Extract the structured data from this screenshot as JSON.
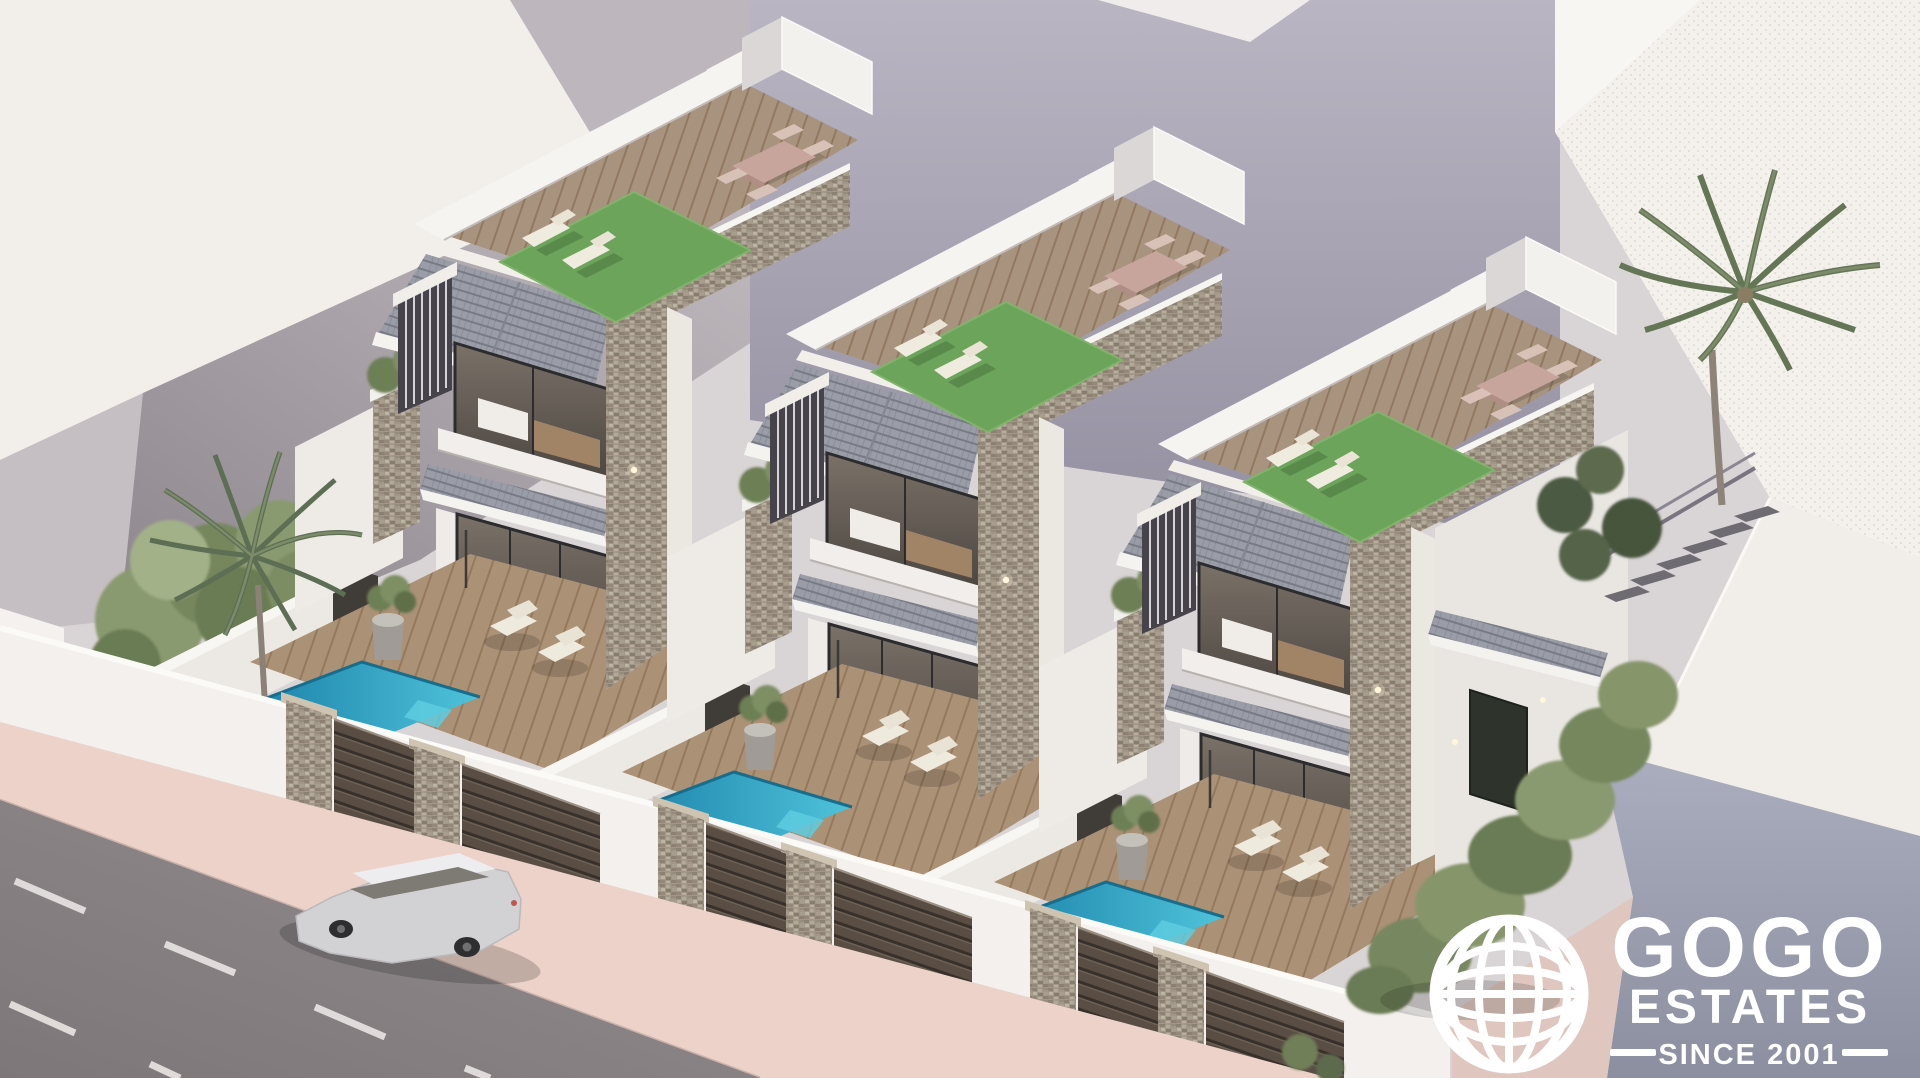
{
  "watermark": {
    "icon": "globe-icon",
    "brand_top": "GOGO",
    "brand_bottom": "ESTATES",
    "tagline": "SINCE 2001",
    "color": "#ffffff"
  },
  "scene": {
    "type": "architectural-exterior-render",
    "description": "Aerial 3D rendering of a row of three identical modern two-storey villas, each with a street gate, plunge pool, timber deck terrace, first-floor balcony, pitched grey tile roof sections, a stone-clad pier and a roof terrace with artificial grass, sun loungers and a dining set; surrounded by white neighbouring buildings, palm trees, a hedge, an exterior staircase and a street with a silver SUV.",
    "counts": {
      "villas": 3,
      "pools": 3,
      "roof_terraces": 3,
      "street_gates": 3,
      "palm_trees": 2,
      "cars": 1
    },
    "palette": {
      "background_building": "#f3f0ec",
      "shaded_wall": "#9b96a2",
      "villa_white": "#f2efec",
      "roof_tile": "#979aa4",
      "stone_cladding": "#a29889",
      "deck_wood": "#ab9176",
      "grass": "#6ca45b",
      "pool_water": "#2fa3c6",
      "gate_metal": "#574b41",
      "road": "#8a8486",
      "sidewalk": "#ecd2c9",
      "foliage": "#77875e",
      "car": "#d2d2d4"
    }
  }
}
